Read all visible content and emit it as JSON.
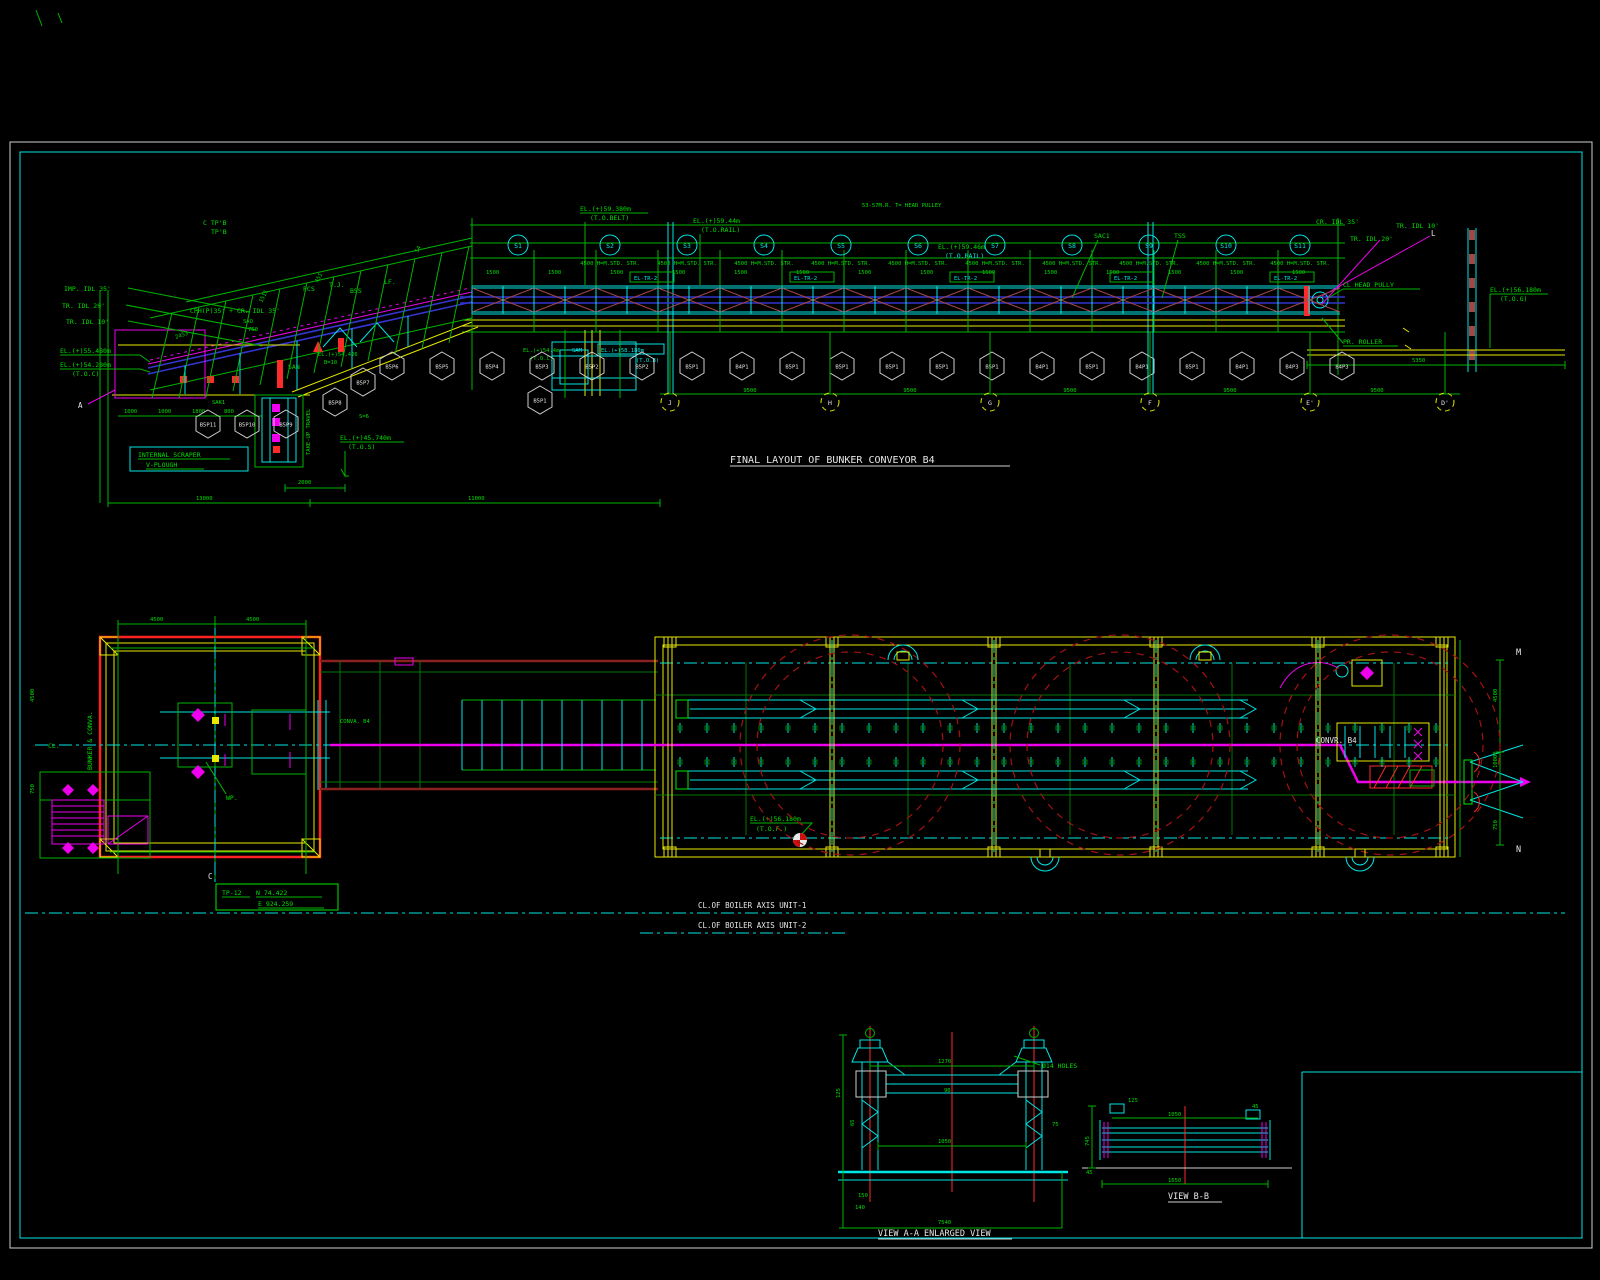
{
  "colors": {
    "green": "#00df00",
    "cyan": "#00e5e5",
    "yellow": "#e8e800",
    "magenta": "#ee00ee",
    "red": "#ff2a2a",
    "navy": "#3434cf",
    "dark_red": "#a31212",
    "white": "#e8e8e8",
    "background": "#000000"
  },
  "elevation": {
    "title": "FINAL LAYOUT OF BUNKER CONVEYOR  B4",
    "labels": {
      "imp_idl": "IMP. IDL 35'",
      "tr_idl_20": "TR. IDL 20'",
      "tr_idl_10": "TR. IDL 10'",
      "el_55480": "EL.(+)55.480m",
      "el_54280": "EL.(+)54.280m",
      "toc": "(T.O.C)",
      "cph": "CPH(P)35' + CR. IDL 35'",
      "sao": "SAO",
      "s750": "750",
      "ctp": "C TP'B",
      "tpb": "TP'B",
      "pcs": "PCS",
      "tj": "T.J.",
      "bss": "BSS",
      "lf": "LF.",
      "el_59380": "EL.(+)59.380m",
      "to_belt": "(T.O.BELT)",
      "el_5944": "EL.(+)59.44m",
      "to_rail": "(T.O.RAIL)",
      "head_note": "53-57M.R. T= HEAD PULLEY",
      "el_5946": "EL.(+)59.46m",
      "to_rail2": "(T.O.RAIL)",
      "sac1": "SAC1",
      "tss": "TSS",
      "san": "SAN",
      "sak": "SAK1",
      "sam": "SAM",
      "cr_idl_35": "CR. IDL 35'",
      "tr_idl_10r": "TR. IDL 10'",
      "tr_idl_20r": "TR. IDL 20'",
      "cl_head": "CL HEAD PULLY",
      "pr_roller": "PR. ROLLER",
      "el_56180": "EL.(+)56.180m",
      "tog": "(T.O.G)",
      "el_54426": "EL.(+)54,426",
      "b10": "B=10",
      "el_544": "EL.(+)54.4m",
      "toc2": "(T.O.C)",
      "el_58180": "EL.(+)58.180m",
      "tob": "(T.O.B)",
      "scraper1": "INTERNAL SCRAPER",
      "scraper2": "V-PLOUGH",
      "el_45740": "EL.(+)45.740m",
      "tos": "(T.O.S)",
      "take_up": "TAKE-UP TRAVEL",
      "s6": "S=6",
      "std_str": "4500 H=M.STD. STR.",
      "el_tr2": "EL-TR-2",
      "a_mark": "A",
      "l_mark": "L"
    },
    "bubbles": [
      "S1",
      "S2",
      "S3",
      "S4",
      "S5",
      "S6",
      "S7",
      "S8",
      "S9",
      "S10",
      "S11"
    ],
    "hex_row": [
      "B5P6",
      "B5P5",
      "B5P4",
      "B5P3",
      "B5P2",
      "B5P2",
      "B5P1",
      "B4P1",
      "B5P1",
      "B5P1",
      "B5P1",
      "B5P1",
      "B5P1",
      "B4P1",
      "B5P1",
      "B4P1",
      "B5P1",
      "B4P1",
      "B4P3",
      "B4P3"
    ],
    "hex_extra": [
      {
        "x": 363,
        "y": 382,
        "t": "B5P7"
      },
      {
        "x": 335,
        "y": 402,
        "t": "B5P8"
      },
      {
        "x": 540,
        "y": 400,
        "t": "B5P1"
      },
      {
        "x": 208,
        "y": 424,
        "t": "B5P11"
      },
      {
        "x": 247,
        "y": 424,
        "t": "B5P10"
      },
      {
        "x": 286,
        "y": 424,
        "t": "B5P9"
      }
    ],
    "grid_letters": [
      "J",
      "H",
      "G",
      "F",
      "E'",
      "D'"
    ],
    "incline_dims": [
      "2453",
      "1511",
      "451",
      "54"
    ],
    "row_dims": [
      "1000",
      "1000",
      "1800",
      "800"
    ],
    "dims": {
      "d13000": "13000",
      "d11000": "11000",
      "d2000": "2000",
      "d9500": "9500",
      "d5350": "5350",
      "d1500": "1500"
    }
  },
  "plan": {
    "labels": {
      "cl": "CL.",
      "bunker_conva": "BUNKER & CONVA.",
      "wp": "WP.",
      "conva_b4": "CONVA. B4",
      "convr_b4": "CONVR. B4",
      "el_56180": "EL.(+)56.180m",
      "tof": "(T.O.F.)",
      "tp12": "TP-12",
      "north": "N 74.422",
      "east": "E 924.259",
      "m": "M",
      "n": "N",
      "c": "C",
      "axis1": "CL.OF BOILER AXIS UNIT-1",
      "axis2": "CL.OF BOILER AXIS UNIT-2"
    },
    "dims": {
      "top1": "4500",
      "top2": "4500",
      "left1": "4500",
      "left2": "750",
      "right1": "4500",
      "right2": "10000",
      "right3": "750"
    }
  },
  "views": {
    "aa": {
      "caption": "VIEW A-A ENLARGED VIEW",
      "holes": "Ø14 HOLES",
      "dims": {
        "top": "1270",
        "beam": "90",
        "mid": "1050",
        "l1": "125",
        "l2": "65",
        "r1": "75",
        "b1": "150",
        "b2": "140",
        "overall": "7540"
      }
    },
    "bb": {
      "caption": "VIEW B-B",
      "dims": {
        "top": "1050",
        "l1": "745",
        "l2": "45",
        "c1": "125",
        "c2": "45",
        "bottom": "1650"
      }
    }
  }
}
